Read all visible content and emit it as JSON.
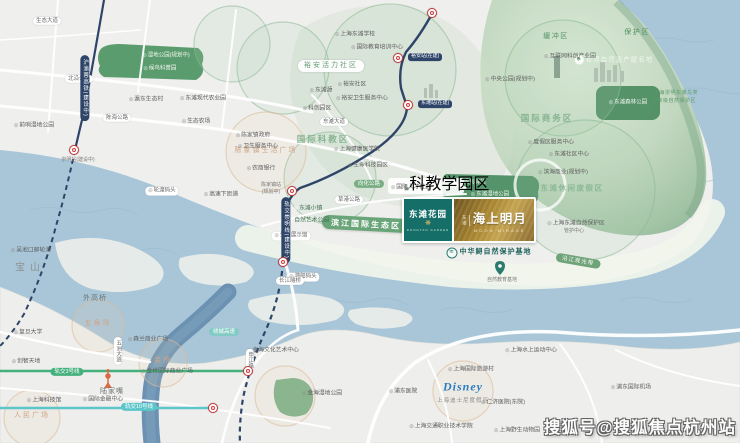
{
  "map": {
    "colors": {
      "land": "#efefed",
      "water": "#a9c6d8",
      "river_dark": "#6b92b2",
      "reserve_green": "#86ae8e",
      "park_green": "#5b9c6e",
      "navy_rail": "#2e4468",
      "metro_green": "#44b07c",
      "metro_teal": "#5cc6ca",
      "station_red": "#c9393b",
      "ribbon_green": "#69a578",
      "logo_teal": "#156f68",
      "logo_gold": "#a8852f"
    },
    "project": {
      "teal_logo": {
        "icon": "wheat-sprig-icon",
        "name": "东滩花园",
        "latin": "DONGTAN GARDEN"
      },
      "gold_logo": {
        "prefix": "东滩",
        "name": "海上明月",
        "latin": "MOON MIRAGE"
      }
    },
    "disney": {
      "script": "Disney",
      "label": "上海迪士尼度假区"
    },
    "watermark": "搜狐号@搜狐焦点杭州站",
    "labels": [
      {
        "t": "缓冲区",
        "x": 556,
        "y": 37,
        "c": "zg",
        "n": "zone-buffer"
      },
      {
        "t": "保护区",
        "x": 637,
        "y": 33,
        "c": "zg",
        "n": "zone-protection"
      },
      {
        "t": "世界自然遗产提名地",
        "x": 614,
        "y": 60,
        "c": "heritage",
        "n": "heritage-badge"
      },
      {
        "t": "上海崇明东滩鸟类",
        "x": 676,
        "y": 94,
        "c": "tg"
      },
      {
        "t": "国家级自然保护区",
        "x": 674,
        "y": 102,
        "c": "tg"
      },
      {
        "t": "东滩森林公园",
        "x": 628,
        "y": 103,
        "c": "park-item",
        "n": "park-dongtan-forest"
      },
      {
        "t": "裕安活力社区",
        "x": 331,
        "y": 66,
        "c": "pill-zone",
        "n": "zone-yuan-community"
      },
      {
        "t": "国际商务区",
        "x": 547,
        "y": 119,
        "c": "zg-lg",
        "n": "zone-business-district"
      },
      {
        "t": "国际科教区",
        "x": 323,
        "y": 140,
        "c": "zg-lg",
        "n": "zone-science-education"
      },
      {
        "t": "东滩休闲度假区",
        "x": 572,
        "y": 189,
        "c": "zg-soft",
        "n": "zone-resort"
      },
      {
        "t": "滨江国际生态区",
        "x": 366,
        "y": 224,
        "c": "ribbon",
        "r": 3,
        "n": "zone-riverside-eco"
      },
      {
        "t": "陈家镇生活广场",
        "x": 266,
        "y": 151,
        "c": "ztan"
      },
      {
        "t": "五角场",
        "x": 98,
        "y": 324,
        "c": "ztan"
      },
      {
        "t": "金桥",
        "x": 163,
        "y": 361,
        "c": "ztan"
      },
      {
        "t": "人民广场",
        "x": 32,
        "y": 416,
        "c": "ztan"
      },
      {
        "t": "宝山",
        "x": 30,
        "y": 268,
        "c": "district",
        "n": "district-baoshan"
      },
      {
        "t": "外高桥",
        "x": 95,
        "y": 299,
        "c": "district-sm"
      },
      {
        "t": "陆家嘴",
        "x": 112,
        "y": 392,
        "c": "district-sm"
      },
      {
        "t": "湿地公园(规划中)",
        "x": 166,
        "y": 56,
        "c": "park-item"
      },
      {
        "t": "候鸟科普园",
        "x": 160,
        "y": 69,
        "c": "park-item"
      },
      {
        "t": "候鸟驿站",
        "x": 472,
        "y": 183,
        "c": "park-item"
      },
      {
        "t": "东滩湿地公园",
        "x": 490,
        "y": 195,
        "c": "park-item"
      },
      {
        "t": "中华鲟自然保护基地",
        "x": 489,
        "y": 253,
        "c": "coast-title",
        "n": "sturgeon-base-label"
      },
      {
        "t": "沿江观光带",
        "x": 578,
        "y": 261,
        "c": "pill-green",
        "r": 10
      },
      {
        "t": "自然教育基地",
        "x": 502,
        "y": 281,
        "c": "tinygray"
      },
      {
        "t": "游船码头",
        "x": 303,
        "y": 277,
        "c": "pill-white"
      },
      {
        "t": "生态展示馆",
        "x": 291,
        "y": 236,
        "c": "pill-white"
      },
      {
        "t": "轮渡码头",
        "x": 162,
        "y": 191,
        "c": "pill-white"
      },
      {
        "t": "瀛东生态村",
        "x": 146,
        "y": 100,
        "c": "poi"
      },
      {
        "t": "东滩现代农业园",
        "x": 203,
        "y": 99,
        "c": "poi"
      },
      {
        "t": "生态农场",
        "x": 196,
        "y": 122,
        "c": "poi"
      },
      {
        "t": "前哨湿地公园",
        "x": 34,
        "y": 126,
        "c": "poi"
      },
      {
        "t": "上海东滩学校",
        "x": 355,
        "y": 35,
        "c": "poi"
      },
      {
        "t": "国际教育培训中心",
        "x": 377,
        "y": 48,
        "c": "poi"
      },
      {
        "t": "裕安社区",
        "x": 352,
        "y": 85,
        "c": "poi"
      },
      {
        "t": "裕安卫生服务中心",
        "x": 362,
        "y": 99,
        "c": "poi"
      },
      {
        "t": "东滩源",
        "x": 321,
        "y": 91,
        "c": "poi"
      },
      {
        "t": "科创园区",
        "x": 317,
        "y": 109,
        "c": "poi"
      },
      {
        "t": "互联网科创产业园",
        "x": 570,
        "y": 57,
        "c": "poi"
      },
      {
        "t": "中央公园(规划中)",
        "x": 510,
        "y": 80,
        "c": "poi"
      },
      {
        "t": "陈家镇政府",
        "x": 253,
        "y": 136,
        "c": "poi"
      },
      {
        "t": "卫生服务中心",
        "x": 258,
        "y": 147,
        "c": "poi"
      },
      {
        "t": "农商银行",
        "x": 261,
        "y": 169,
        "c": "poi"
      },
      {
        "t": "上海健康医学院",
        "x": 357,
        "y": 150,
        "c": "poi"
      },
      {
        "t": "生命科技园区",
        "x": 368,
        "y": 166,
        "c": "poi"
      },
      {
        "t": "国际人才社区",
        "x": 411,
        "y": 188,
        "c": "poi"
      },
      {
        "t": "科教学园区",
        "x": 447,
        "y": 185,
        "c": "poi-bld"
      },
      {
        "t": "东滩小镇",
        "x": 308,
        "y": 209,
        "c": "poi-light"
      },
      {
        "t": "自然艺术公园",
        "x": 309,
        "y": 221,
        "c": "poi-light"
      },
      {
        "t": "度假区服务中心",
        "x": 551,
        "y": 143,
        "c": "poi"
      },
      {
        "t": "东滩社区中心",
        "x": 569,
        "y": 155,
        "c": "poi"
      },
      {
        "t": "滨海商业(规划中)",
        "x": 563,
        "y": 173,
        "c": "poi"
      },
      {
        "t": "上海东滩自然保护区",
        "x": 576,
        "y": 224,
        "c": "poi"
      },
      {
        "t": "管护中心",
        "x": 574,
        "y": 232,
        "c": "tinygray"
      },
      {
        "t": "高速下匝道",
        "x": 221,
        "y": 195,
        "c": "poi"
      },
      {
        "t": "裕安站(在建)",
        "x": 408,
        "y": 57,
        "c": "pill-navy-sm",
        "n": "station-label-yuan"
      },
      {
        "t": "东滩站(在建)",
        "x": 418,
        "y": 104,
        "c": "pill-navy-sm",
        "n": "station-label-dongtan"
      },
      {
        "t": "陈家镇站",
        "x": 271,
        "y": 186,
        "c": "tinygray",
        "n": "station-label-chenjiazhen"
      },
      {
        "t": "(规划中)",
        "x": 271,
        "y": 193,
        "c": "tinygray"
      },
      {
        "t": "崇明站(建设中)",
        "x": 78,
        "y": 161,
        "c": "tinygray",
        "n": "station-label-chongming"
      },
      {
        "t": "吴淞口邮轮港",
        "x": 31,
        "y": 251,
        "c": "poi"
      },
      {
        "t": "复旦大学",
        "x": 28,
        "y": 333,
        "c": "poi"
      },
      {
        "t": "创智天地",
        "x": 26,
        "y": 362,
        "c": "poi"
      },
      {
        "t": "森兰商业广场",
        "x": 148,
        "y": 340,
        "c": "poi"
      },
      {
        "t": "金桥国际商业广场",
        "x": 167,
        "y": 372,
        "c": "poi"
      },
      {
        "t": "上海科技馆",
        "x": 44,
        "y": 401,
        "c": "poi"
      },
      {
        "t": "国际金融中心",
        "x": 103,
        "y": 400,
        "c": "poi"
      },
      {
        "t": "金海文化艺术中心",
        "x": 273,
        "y": 351,
        "c": "poi"
      },
      {
        "t": "金海湿地公园",
        "x": 322,
        "y": 394,
        "c": "poi"
      },
      {
        "t": "上海水上运动中心",
        "x": 531,
        "y": 351,
        "c": "poi"
      },
      {
        "t": "上海国际旅游村",
        "x": 471,
        "y": 370,
        "c": "poi"
      },
      {
        "t": "浦东医院",
        "x": 403,
        "y": 392,
        "c": "poi"
      },
      {
        "t": "仁济医院(东院)",
        "x": 503,
        "y": 403,
        "c": "poi"
      },
      {
        "t": "上海交通职业技术学院",
        "x": 441,
        "y": 427,
        "c": "poi"
      },
      {
        "t": "上海野生动物园",
        "x": 517,
        "y": 431,
        "c": "poi"
      },
      {
        "t": "浦东国际机场",
        "x": 631,
        "y": 388,
        "c": "poi"
      },
      {
        "t": "生态大道",
        "x": 47,
        "y": 21,
        "c": "pill-road"
      },
      {
        "t": "北沿公路",
        "x": 79,
        "y": 79,
        "c": "pill-road"
      },
      {
        "t": "陈海公路",
        "x": 117,
        "y": 118,
        "c": "pill-road"
      },
      {
        "t": "东滩大道",
        "x": 334,
        "y": 122,
        "c": "pill-road"
      },
      {
        "t": "草港公路",
        "x": 349,
        "y": 200,
        "c": "pill-road"
      },
      {
        "t": "向化公路",
        "x": 369,
        "y": 184,
        "c": "pill-green-sm"
      },
      {
        "t": "长江隧桥",
        "x": 290,
        "y": 281,
        "c": "pill-road"
      },
      {
        "t": "绕城高速",
        "x": 224,
        "y": 332,
        "c": "pill-teal"
      },
      {
        "t": "轨交3号线",
        "x": 67,
        "y": 372,
        "c": "pill-mgreen",
        "n": "metro-line3-label"
      },
      {
        "t": "轨交10号线",
        "x": 139,
        "y": 407,
        "c": "pill-mteal",
        "n": "metro-line10-label"
      },
      {
        "t": "申江路",
        "x": 250,
        "y": 360,
        "c": "pill-road-v"
      },
      {
        "t": "五洲大道",
        "x": 118,
        "y": 351,
        "c": "pill-road-v"
      },
      {
        "t": "沪渝蓉高铁(建设中)",
        "x": 85,
        "y": 88,
        "c": "pill-navy-v",
        "n": "rail-hsr-label"
      },
      {
        "t": "轨交崇明线(建设中)",
        "x": 286,
        "y": 230,
        "c": "pill-navy-v",
        "n": "rail-chongming-line-label"
      }
    ],
    "stations": [
      [
        398,
        58
      ],
      [
        408,
        105
      ],
      [
        292,
        191
      ],
      [
        283,
        262
      ],
      [
        74,
        150
      ],
      [
        432,
        13
      ],
      [
        248,
        371
      ],
      [
        213,
        408
      ]
    ]
  }
}
